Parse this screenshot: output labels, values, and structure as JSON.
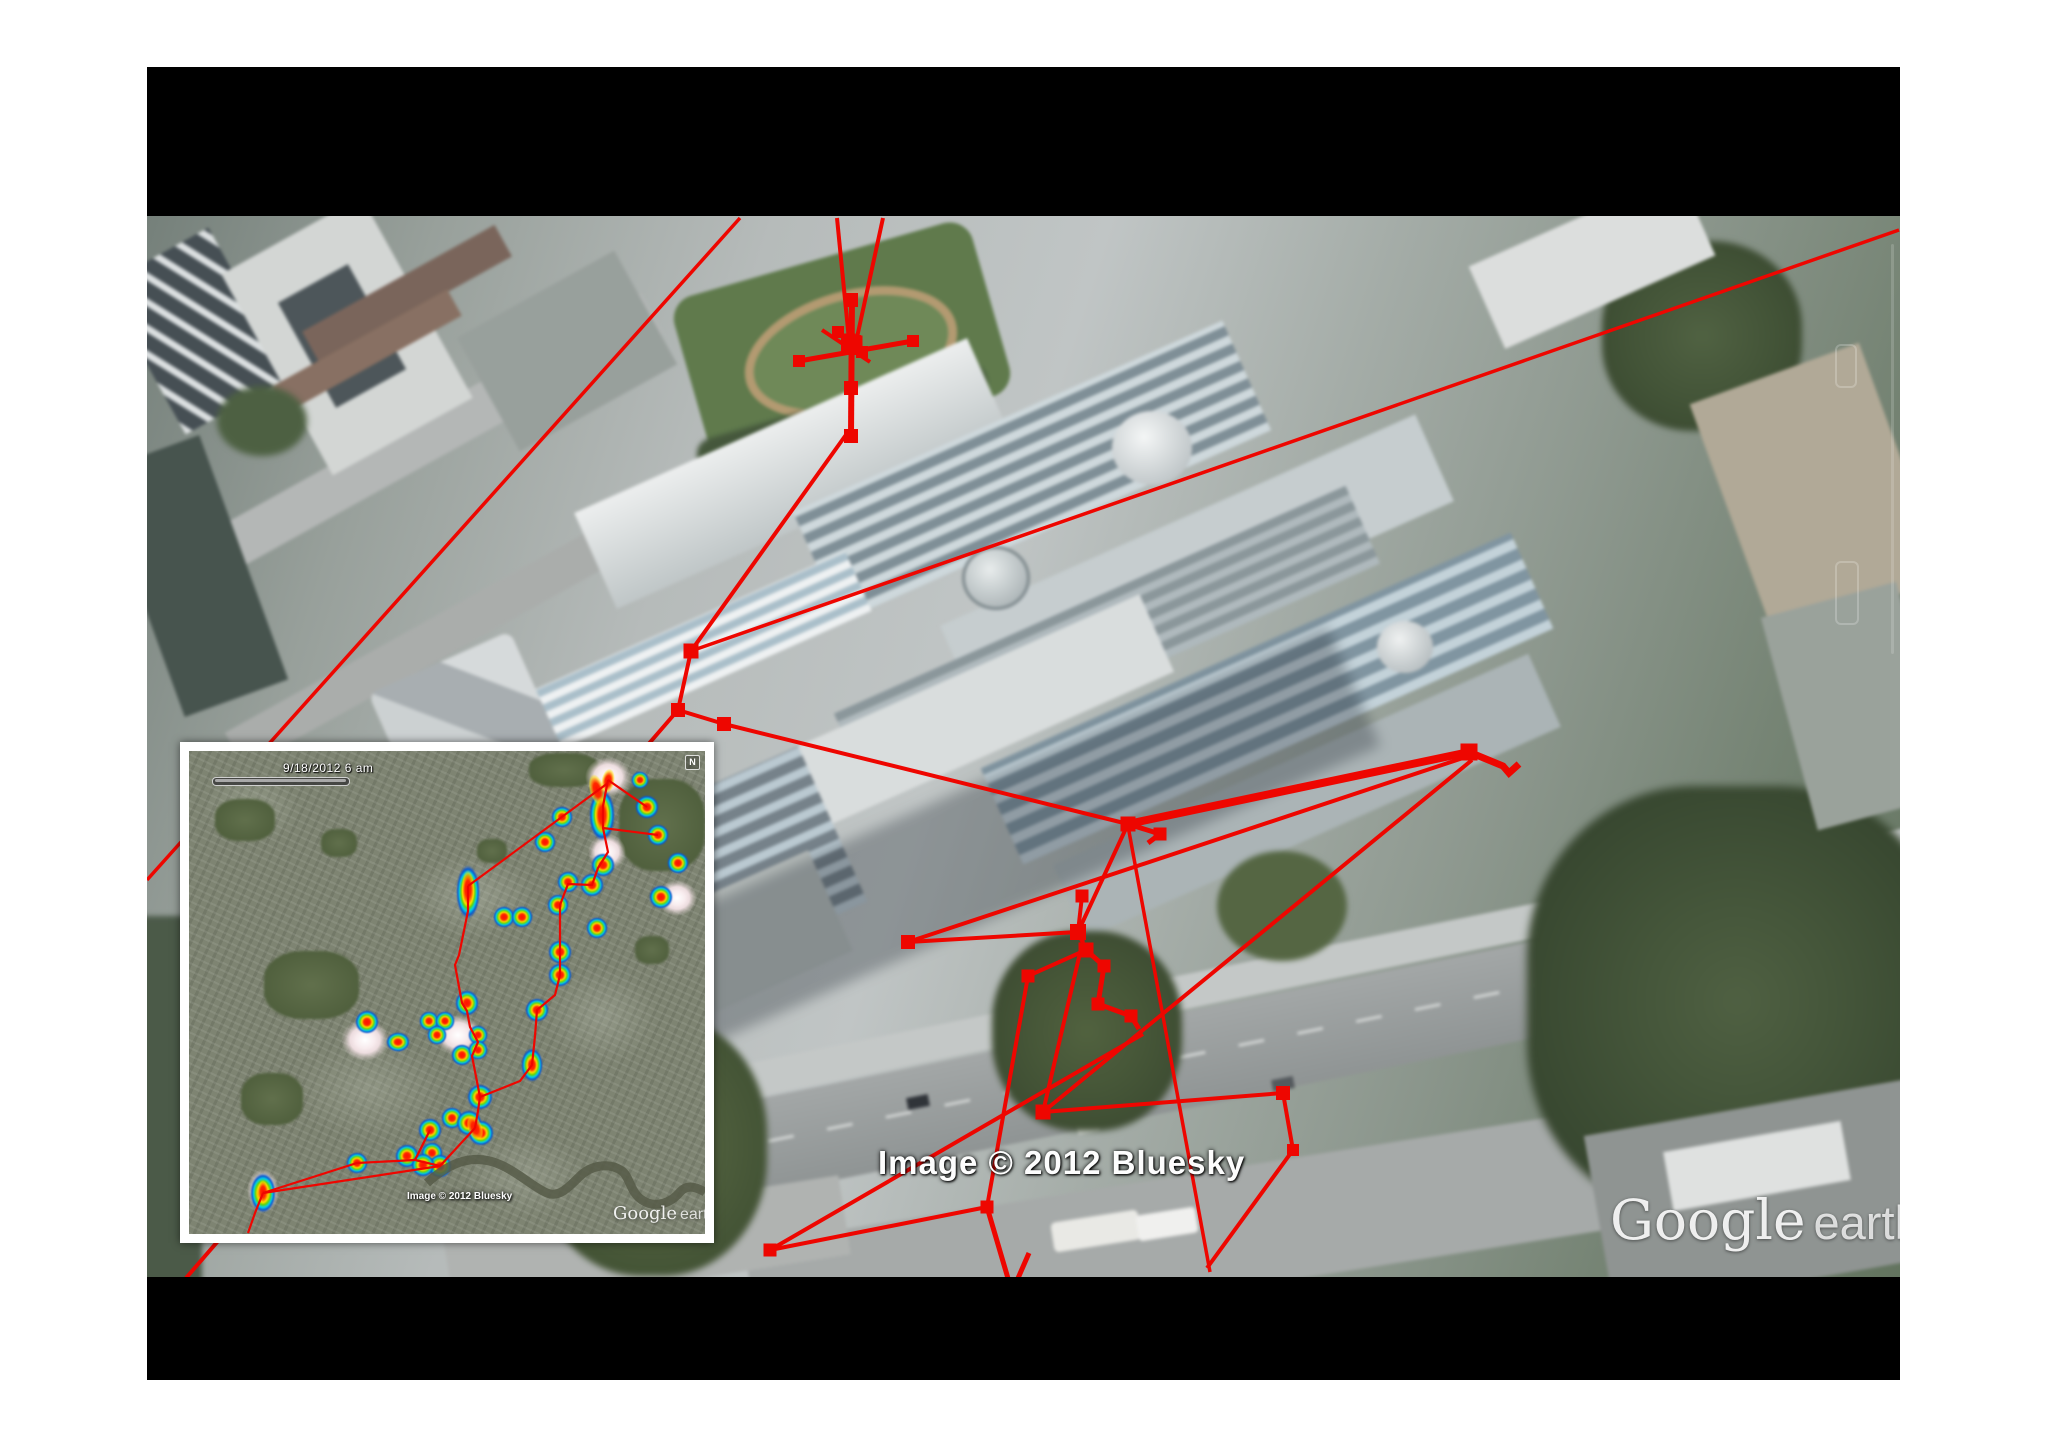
{
  "app": {
    "name": "Google Earth"
  },
  "colors": {
    "track_red": "#ee0600",
    "frame_black": "#000000",
    "inset_border": "#ffffff"
  },
  "main_map": {
    "attribution": "Image © 2012 Bluesky",
    "watermark_brand": "Google",
    "watermark_product": "earth",
    "tracks": {
      "segments": [
        {
          "p": [
            [
              837,
              218
            ],
            [
              849,
              340
            ]
          ],
          "w": 4
        },
        {
          "p": [
            [
              883,
              218
            ],
            [
              856,
              342
            ]
          ],
          "w": 4
        },
        {
          "p": [
            [
              852,
              293
            ],
            [
              851,
              436
            ]
          ],
          "w": 6
        },
        {
          "p": [
            [
              799,
              361
            ],
            [
              913,
              341
            ]
          ],
          "w": 5
        },
        {
          "p": [
            [
              822,
              330
            ],
            [
              870,
              362
            ]
          ],
          "w": 4
        },
        {
          "p": [
            [
              1899,
              230
            ],
            [
              691,
              651
            ]
          ],
          "w": 3.5
        },
        {
          "p": [
            [
              740,
              218
            ],
            [
              147,
              880
            ]
          ],
          "w": 3.5
        },
        {
          "p": [
            [
              848,
              432
            ],
            [
              691,
              651
            ]
          ],
          "w": 4
        },
        {
          "p": [
            [
              691,
              651
            ],
            [
              678,
              710
            ],
            [
              724,
              724
            ]
          ],
          "w": 4
        },
        {
          "p": [
            [
              724,
              724
            ],
            [
              1128,
              824
            ]
          ],
          "w": 4
        },
        {
          "p": [
            [
              1469,
              752
            ],
            [
              1128,
              824
            ]
          ],
          "w": 8
        },
        {
          "p": [
            [
              1469,
              752
            ],
            [
              1503,
              766
            ],
            [
              1509,
              773
            ],
            [
              1519,
              764
            ]
          ],
          "w": 7
        },
        {
          "p": [
            [
              1469,
              756
            ],
            [
              908,
              942
            ]
          ],
          "w": 4
        },
        {
          "p": [
            [
              1472,
              760
            ],
            [
              1043,
              1112
            ]
          ],
          "w": 4
        },
        {
          "p": [
            [
              1128,
              824
            ],
            [
              1160,
              834
            ],
            [
              1148,
              843
            ]
          ],
          "w": 5
        },
        {
          "p": [
            [
              1128,
              824
            ],
            [
              1078,
              932
            ]
          ],
          "w": 4
        },
        {
          "p": [
            [
              908,
              942
            ],
            [
              1078,
              932
            ],
            [
              1086,
              950
            ]
          ],
          "w": 4
        },
        {
          "p": [
            [
              1078,
              932
            ],
            [
              1082,
              896
            ]
          ],
          "w": 4
        },
        {
          "p": [
            [
              1086,
              950
            ],
            [
              1104,
              966
            ],
            [
              1098,
              1004
            ],
            [
              1131,
              1016
            ],
            [
              1139,
              1029
            ]
          ],
          "w": 5
        },
        {
          "p": [
            [
              1083,
              940
            ],
            [
              1043,
              1112
            ]
          ],
          "w": 4
        },
        {
          "p": [
            [
              1043,
              1112
            ],
            [
              1283,
              1093
            ]
          ],
          "w": 4
        },
        {
          "p": [
            [
              1283,
              1093
            ],
            [
              1293,
              1150
            ],
            [
              1207,
              1268
            ]
          ],
          "w": 4
        },
        {
          "p": [
            [
              1128,
              826
            ],
            [
              1210,
              1272
            ]
          ],
          "w": 3.5
        },
        {
          "p": [
            [
              1086,
              950
            ],
            [
              1028,
              976
            ],
            [
              987,
              1207
            ]
          ],
          "w": 4
        },
        {
          "p": [
            [
              987,
              1207
            ],
            [
              770,
              1250
            ]
          ],
          "w": 4
        },
        {
          "p": [
            [
              770,
              1250
            ],
            [
              1143,
              1034
            ]
          ],
          "w": 4
        },
        {
          "p": [
            [
              987,
              1207
            ],
            [
              1012,
              1292
            ],
            [
              1029,
              1253
            ]
          ],
          "w": 5
        },
        {
          "p": [
            [
              678,
              710
            ],
            [
              186,
              1278
            ]
          ],
          "w": 4
        }
      ],
      "markers": [
        [
          849,
          340,
          13
        ],
        [
          856,
          342,
          13
        ],
        [
          851,
          300,
          14
        ],
        [
          851,
          345,
          20
        ],
        [
          851,
          388,
          14
        ],
        [
          851,
          436,
          14
        ],
        [
          799,
          361,
          12
        ],
        [
          913,
          341,
          12
        ],
        [
          838,
          332,
          12
        ],
        [
          862,
          352,
          12
        ],
        [
          691,
          651,
          15
        ],
        [
          678,
          710,
          14
        ],
        [
          724,
          724,
          14
        ],
        [
          1128,
          824,
          15
        ],
        [
          1160,
          834,
          13
        ],
        [
          1469,
          752,
          17
        ],
        [
          1082,
          896,
          13
        ],
        [
          1078,
          932,
          16
        ],
        [
          1086,
          950,
          15
        ],
        [
          1104,
          966,
          13
        ],
        [
          1098,
          1004,
          13
        ],
        [
          1131,
          1016,
          13
        ],
        [
          1028,
          976,
          13
        ],
        [
          1043,
          1112,
          15
        ],
        [
          1283,
          1093,
          14
        ],
        [
          1293,
          1150,
          12
        ],
        [
          908,
          942,
          14
        ],
        [
          987,
          1207,
          13
        ],
        [
          770,
          1250,
          13
        ],
        [
          1012,
          1292,
          12
        ]
      ]
    }
  },
  "inset_map": {
    "timestamp": "9/18/2012  6 am",
    "compass_label": "N",
    "attribution": "Image © 2012 Bluesky",
    "watermark_brand": "Google",
    "watermark_product": "earth",
    "timeline": {
      "progress_percent": 96
    },
    "heat_blobs": [
      [
        458,
        56,
        24,
        24
      ],
      [
        451,
        29,
        18,
        18
      ],
      [
        373,
        66,
        22,
        22
      ],
      [
        356,
        91,
        22,
        22
      ],
      [
        469,
        84,
        22,
        22
      ],
      [
        414,
        114,
        24,
        24
      ],
      [
        379,
        131,
        22,
        22
      ],
      [
        403,
        134,
        24,
        24
      ],
      [
        489,
        112,
        22,
        22
      ],
      [
        472,
        146,
        24,
        24
      ],
      [
        408,
        177,
        22,
        22
      ],
      [
        369,
        154,
        22,
        22
      ],
      [
        371,
        201,
        24,
        24
      ],
      [
        371,
        224,
        24,
        24
      ],
      [
        348,
        259,
        24,
        24
      ],
      [
        278,
        252,
        24,
        26
      ],
      [
        178,
        271,
        24,
        24
      ],
      [
        209,
        291,
        24,
        20
      ],
      [
        273,
        304,
        22,
        22
      ],
      [
        291,
        346,
        26,
        26
      ],
      [
        263,
        367,
        22,
        22
      ],
      [
        241,
        379,
        24,
        24
      ],
      [
        243,
        402,
        22,
        22
      ],
      [
        251,
        415,
        24,
        24
      ],
      [
        168,
        412,
        22,
        22
      ],
      [
        413,
        64,
        26,
        52
      ],
      [
        279,
        141,
        24,
        54
      ],
      [
        315,
        166,
        22,
        22
      ],
      [
        333,
        166,
        22,
        22
      ],
      [
        240,
        270,
        20,
        20
      ],
      [
        256,
        270,
        20,
        20
      ],
      [
        248,
        284,
        20,
        20
      ],
      [
        289,
        284,
        20,
        20
      ],
      [
        289,
        299,
        20,
        20
      ],
      [
        343,
        314,
        22,
        34
      ],
      [
        280,
        372,
        26,
        26
      ],
      [
        292,
        382,
        26,
        26
      ],
      [
        218,
        405,
        24,
        24
      ],
      [
        234,
        414,
        24,
        24
      ],
      [
        74,
        442,
        26,
        40
      ]
    ],
    "pale_blobs": [
      [
        419,
        26,
        46,
        40
      ],
      [
        418,
        101,
        38,
        36
      ],
      [
        488,
        147,
        40,
        36
      ],
      [
        176,
        289,
        48,
        42
      ],
      [
        269,
        284,
        46,
        40
      ],
      [
        74,
        440,
        32,
        44
      ]
    ],
    "red_streaks": [
      [
        408,
        39,
        16,
        34,
        -15
      ],
      [
        419,
        30,
        14,
        26,
        10
      ],
      [
        279,
        138,
        14,
        40,
        0
      ],
      [
        286,
        377,
        16,
        28,
        -20
      ],
      [
        74,
        441,
        12,
        26,
        0
      ],
      [
        413,
        64,
        16,
        40,
        0
      ]
    ],
    "tracks": {
      "segments": [
        {
          "p": [
            [
              419,
              29
            ],
            [
              414,
              55
            ],
            [
              414,
              77
            ],
            [
              419,
              101
            ],
            [
              409,
              117
            ],
            [
              403,
              134
            ],
            [
              379,
              133
            ],
            [
              371,
              154
            ],
            [
              371,
              177
            ],
            [
              371,
              201
            ],
            [
              371,
              224
            ],
            [
              366,
              244
            ],
            [
              348,
              259
            ],
            [
              346,
              285
            ],
            [
              343,
              314
            ],
            [
              331,
              330
            ],
            [
              291,
              346
            ]
          ],
          "w": 2.2
        },
        {
          "p": [
            [
              419,
              32
            ],
            [
              279,
              135
            ]
          ],
          "w": 2.2
        },
        {
          "p": [
            [
              279,
              135
            ],
            [
              279,
              160
            ],
            [
              270,
              204
            ],
            [
              266,
              214
            ],
            [
              273,
              252
            ],
            [
              278,
              260
            ],
            [
              281,
              276
            ],
            [
              289,
              291
            ],
            [
              283,
              305
            ],
            [
              291,
              346
            ]
          ],
          "w": 2.2
        },
        {
          "p": [
            [
              291,
              346
            ],
            [
              289,
              360
            ],
            [
              286,
              377
            ]
          ],
          "w": 2.2
        },
        {
          "p": [
            [
              286,
              377
            ],
            [
              251,
              415
            ],
            [
              226,
              409
            ],
            [
              241,
              379
            ]
          ],
          "w": 2.2
        },
        {
          "p": [
            [
              226,
              409
            ],
            [
              168,
              412
            ],
            [
              74,
              442
            ]
          ],
          "w": 2.2
        },
        {
          "p": [
            [
              74,
              442
            ],
            [
              251,
              415
            ]
          ],
          "w": 2.2
        },
        {
          "p": [
            [
              74,
              442
            ],
            [
              66,
              462
            ],
            [
              59,
              482
            ]
          ],
          "w": 2.2
        },
        {
          "p": [
            [
              458,
              56
            ],
            [
              419,
              29
            ]
          ],
          "w": 2.2
        },
        {
          "p": [
            [
              469,
              84
            ],
            [
              414,
              77
            ]
          ],
          "w": 2.2
        }
      ],
      "markers": []
    }
  }
}
